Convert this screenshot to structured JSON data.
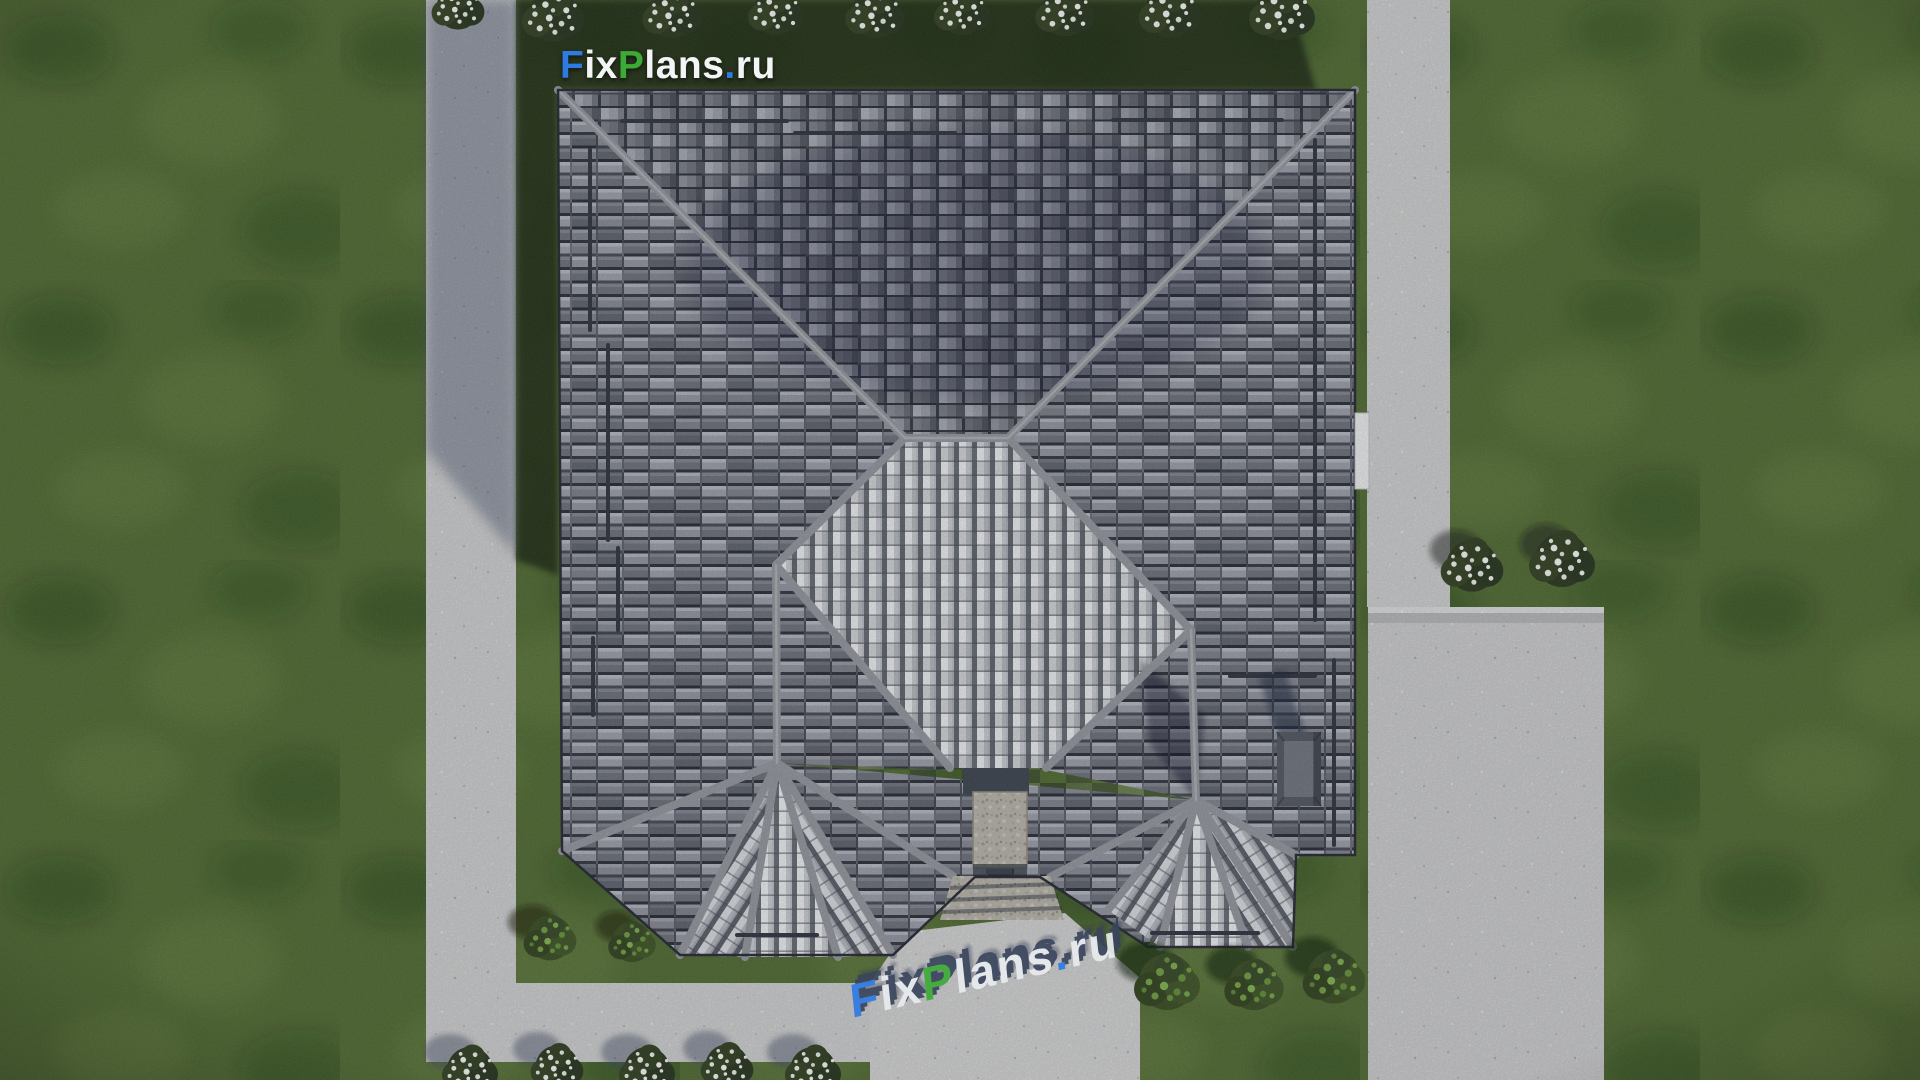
{
  "branding": {
    "site_logo": {
      "text": "FixPlans.ru",
      "segments": [
        {
          "text": "F",
          "color": "#2f7be4"
        },
        {
          "text": "ix",
          "color": "#f3f4f6"
        },
        {
          "text": "P",
          "color": "#3cab36"
        },
        {
          "text": "lans",
          "color": "#f3f4f6"
        },
        {
          "text": ".",
          "color": "#2f7be4"
        },
        {
          "text": "ru",
          "color": "#f3f4f6"
        }
      ]
    },
    "ground_watermark": {
      "text": "FixPlans.ru",
      "segments": [
        {
          "text": "F",
          "color": "#2f7be4"
        },
        {
          "text": "ix",
          "color": "#e9ecef"
        },
        {
          "text": "P",
          "color": "#3cab36"
        },
        {
          "text": "lans",
          "color": "#e9ecef"
        },
        {
          "text": ".",
          "color": "#2f7be4"
        },
        {
          "text": "ru",
          "color": "#e9ecef"
        }
      ]
    }
  },
  "scene": {
    "colors": {
      "lawn": "#4c672e",
      "lawn_shadow": "#17230f",
      "concrete": "#cbcccd",
      "concrete_shadow": "#8e95a3",
      "driveway": "#c8c9cb",
      "roof_tile_light": "#a2a6b0",
      "roof_tile_dark": "#2c303c",
      "roof_tile_bright": "#e9ebee",
      "roof_ridge": "#90939b",
      "stone_porch": "#b5b1a8",
      "chimney": "#4e535d"
    }
  }
}
